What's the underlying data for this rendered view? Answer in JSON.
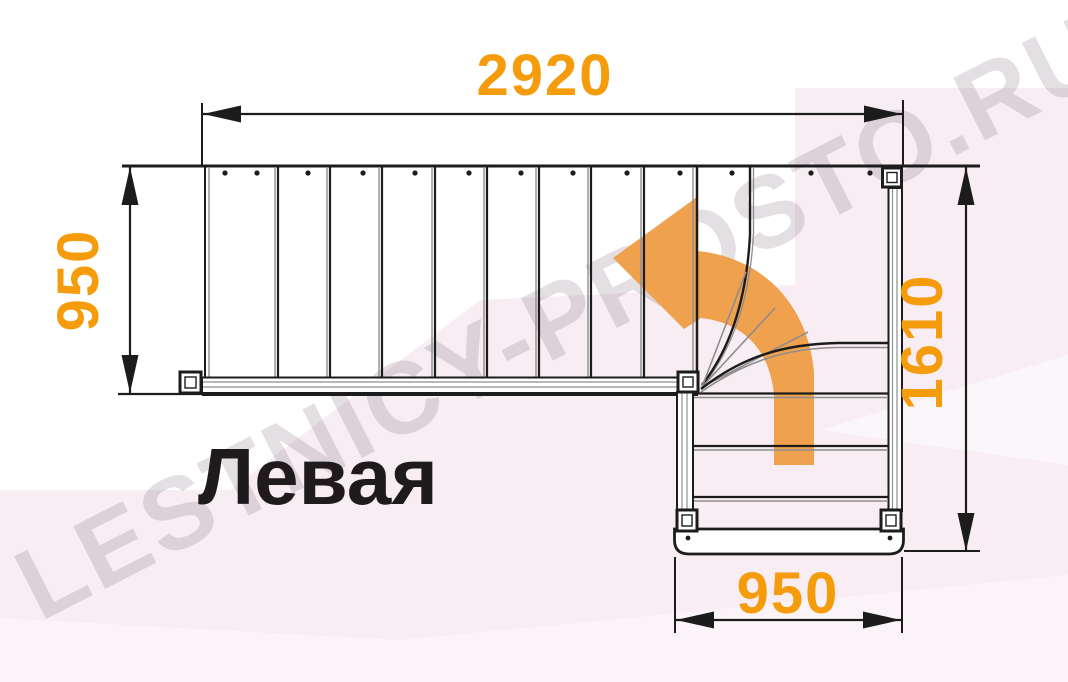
{
  "diagram": {
    "name_label": "Левая",
    "watermark_text": "LESTNICY-PROSTO.RU",
    "dimensions": {
      "top_width": "2920",
      "left_depth": "950",
      "right_height": "1610",
      "bottom_width": "950"
    },
    "stair": {
      "type": "L-shaped staircase plan, left turn",
      "top_flight_steps": 9,
      "winder_steps": 3,
      "bottom_flight_steps": 4,
      "turn_direction": "up then left"
    },
    "colors": {
      "dimension_orange": "#F59C0D",
      "arrow_orange": "#EFA14E",
      "line_dark": "#1C1C1C",
      "line_gray": "#8E8E8E",
      "background_pink": "#F7EDF3",
      "watermark_gray": "rgba(125,106,118,0.21)",
      "label_dark": "#1F1B1D"
    }
  }
}
